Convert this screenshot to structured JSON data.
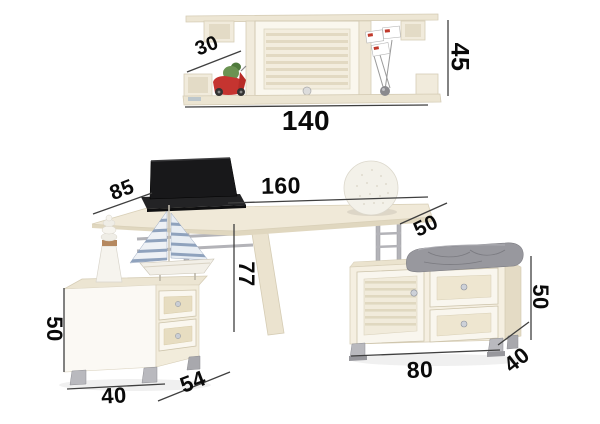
{
  "diagram": {
    "type": "furniture-dimension-diagram",
    "units_shown": "none (numbers only, centimeters implied)"
  },
  "dimensions": {
    "shelf": {
      "depth": "30",
      "width": "140",
      "height": "45"
    },
    "desk": {
      "left_depth": "85",
      "length": "160",
      "right_depth": "50",
      "height": "77"
    },
    "nightstand": {
      "height": "50",
      "width": "40",
      "depth": "54"
    },
    "bench": {
      "width": "80",
      "depth": "40",
      "height": "50"
    }
  },
  "colors": {
    "background": "#ffffff",
    "furniture_body": "#f5efe1",
    "furniture_edge": "#d6cdb6",
    "furniture_face": "#faf7ee",
    "metal": "#b3b3b8",
    "cushion_grey": "#98989e",
    "laptop_black": "#1a1a1c",
    "scooter_red": "#c53430",
    "figure_green": "#6b9352",
    "sail_stripe": "#8fa2bd",
    "dimension_line": "#3f3f3f",
    "dimension_text": "#0a0a0a"
  }
}
